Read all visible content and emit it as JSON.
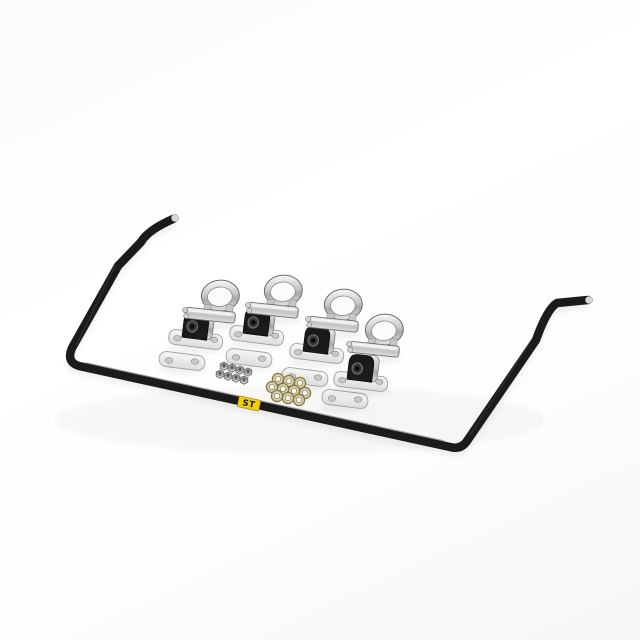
{
  "image": {
    "kind": "product-photo",
    "description": "Black rear anti-sway bar kit laid on a white background with plated mounting hardware arranged diagonally: four U-clamps, four bushing brackets with black rubber bushings, four flat backing plates, a cluster of hex nuts and a cluster of brass washers.",
    "background_color": "#ffffff"
  },
  "bar": {
    "name": "rear sway bar",
    "color": "#1b1b1b",
    "tip_color": "#d8d8d8",
    "label": {
      "text": "ST",
      "background": "#f0cd0f",
      "foreground": "#161616"
    }
  },
  "hardware": {
    "u_clamps": {
      "count": 4,
      "finish_color": "#cfcfcf"
    },
    "bushing_brackets": {
      "count": 4,
      "bracket_color": "#e9e9e9",
      "bushing_color": "#1b1b1b"
    },
    "backing_plates": {
      "count": 4,
      "color": "#ededed"
    },
    "hex_nuts": {
      "count": 8,
      "color": "#c9cdc9"
    },
    "washers": {
      "count": 10,
      "color": "#d8cfae"
    }
  }
}
